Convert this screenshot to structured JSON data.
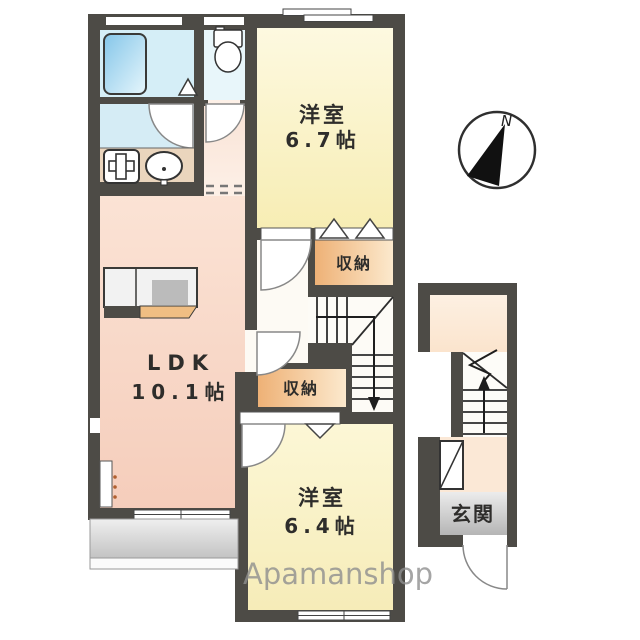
{
  "floorplan": {
    "rooms": {
      "western_room_top": {
        "name": "洋室",
        "size": "6.7帖"
      },
      "ldk": {
        "name": "LDK",
        "size": "10.1帖"
      },
      "western_room_bottom": {
        "name": "洋室",
        "size": "6.4帖"
      },
      "closet_top": {
        "label": "収納"
      },
      "closet_bottom": {
        "label": "収納"
      },
      "entrance": {
        "label": "玄関"
      }
    },
    "compass": {
      "north_label": "N"
    },
    "watermark": {
      "brand": "Apamanshop"
    },
    "colors": {
      "wall": "#4d4b46",
      "room_yellow": "#f7edb4",
      "ldk_pink": "#f5cdbb",
      "closet_orange": "#eeb176",
      "bath_blue": "#85c6e9",
      "balcony_gray": "#c3c3c3",
      "genkan_gray": "#b5b5b5"
    }
  }
}
